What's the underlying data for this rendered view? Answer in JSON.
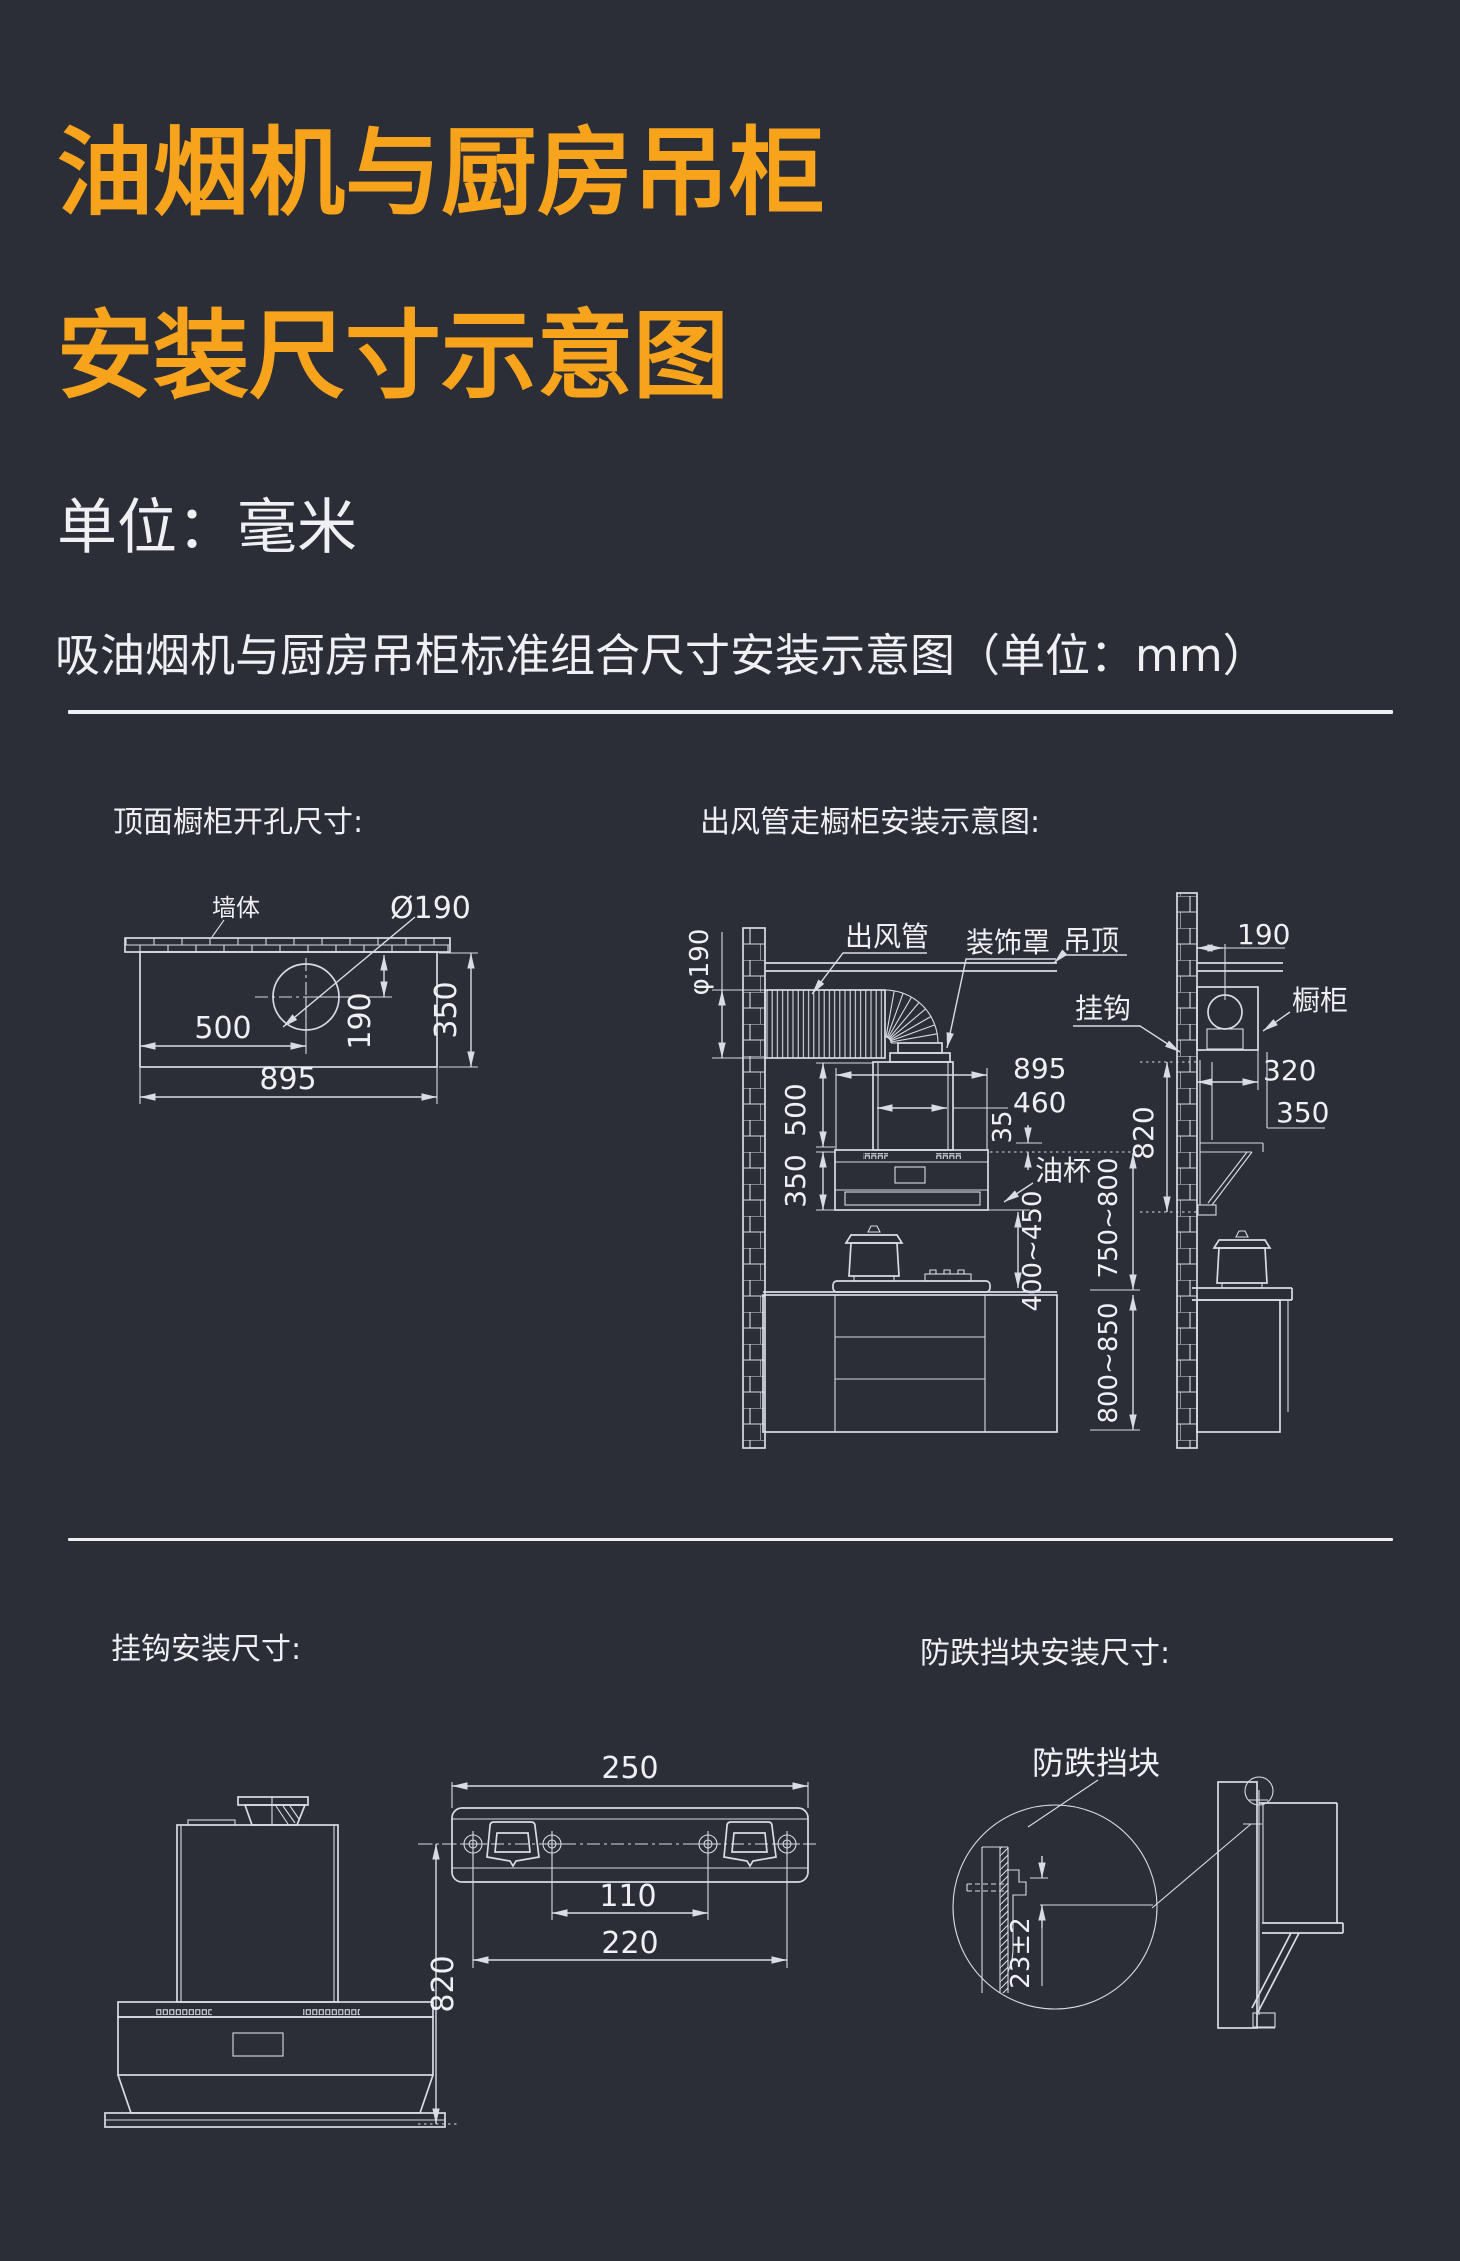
{
  "theme": {
    "bg": "#2b2d37",
    "accent": "#f7a41c",
    "ink": "#eef0f4",
    "line": "#d8dce3"
  },
  "header": {
    "title_line1": "油烟机与厨房吊柜",
    "title_line2": "安装尺寸示意图",
    "unit_note": "单位：毫米",
    "section_heading": "吸油烟机与厨房吊柜标准组合尺寸安装示意图（单位：mm）"
  },
  "top_hole": {
    "title": "顶面橱柜开孔尺寸:",
    "wall": "墙体",
    "hole_dia": "Ø190",
    "width_to_hole_center": "500",
    "total_width": "895",
    "hole_center_from_edge": "190",
    "cabinet_depth": "350"
  },
  "duct": {
    "title": "出风管走橱柜安装示意图:",
    "duct": "出风管",
    "decor_cover": "装饰罩",
    "ceiling": "吊顶",
    "hook": "挂钩",
    "cabinet": "橱柜",
    "oil_cup": "油杯",
    "duct_dia": "φ190",
    "hood_width": "895",
    "chimney_width": "460",
    "overlap": "35",
    "chimney_height": "500",
    "hood_height": "350",
    "wall_to_duct": "190",
    "cabinet_depth": "320",
    "cabinet_height": "350",
    "hook_height": "820",
    "hood_to_counter": "400~450",
    "hood_bottom_to_counter": "750~800",
    "counter_height": "800~850"
  },
  "hook": {
    "title": "挂钩安装尺寸:",
    "plate_width": "250",
    "inner_hole_span": "110",
    "outer_hole_span": "220",
    "hook_to_bottom": "820"
  },
  "block": {
    "title": "防跌挡块安装尺寸:",
    "block": "防跌挡块",
    "drop": "23±2"
  }
}
